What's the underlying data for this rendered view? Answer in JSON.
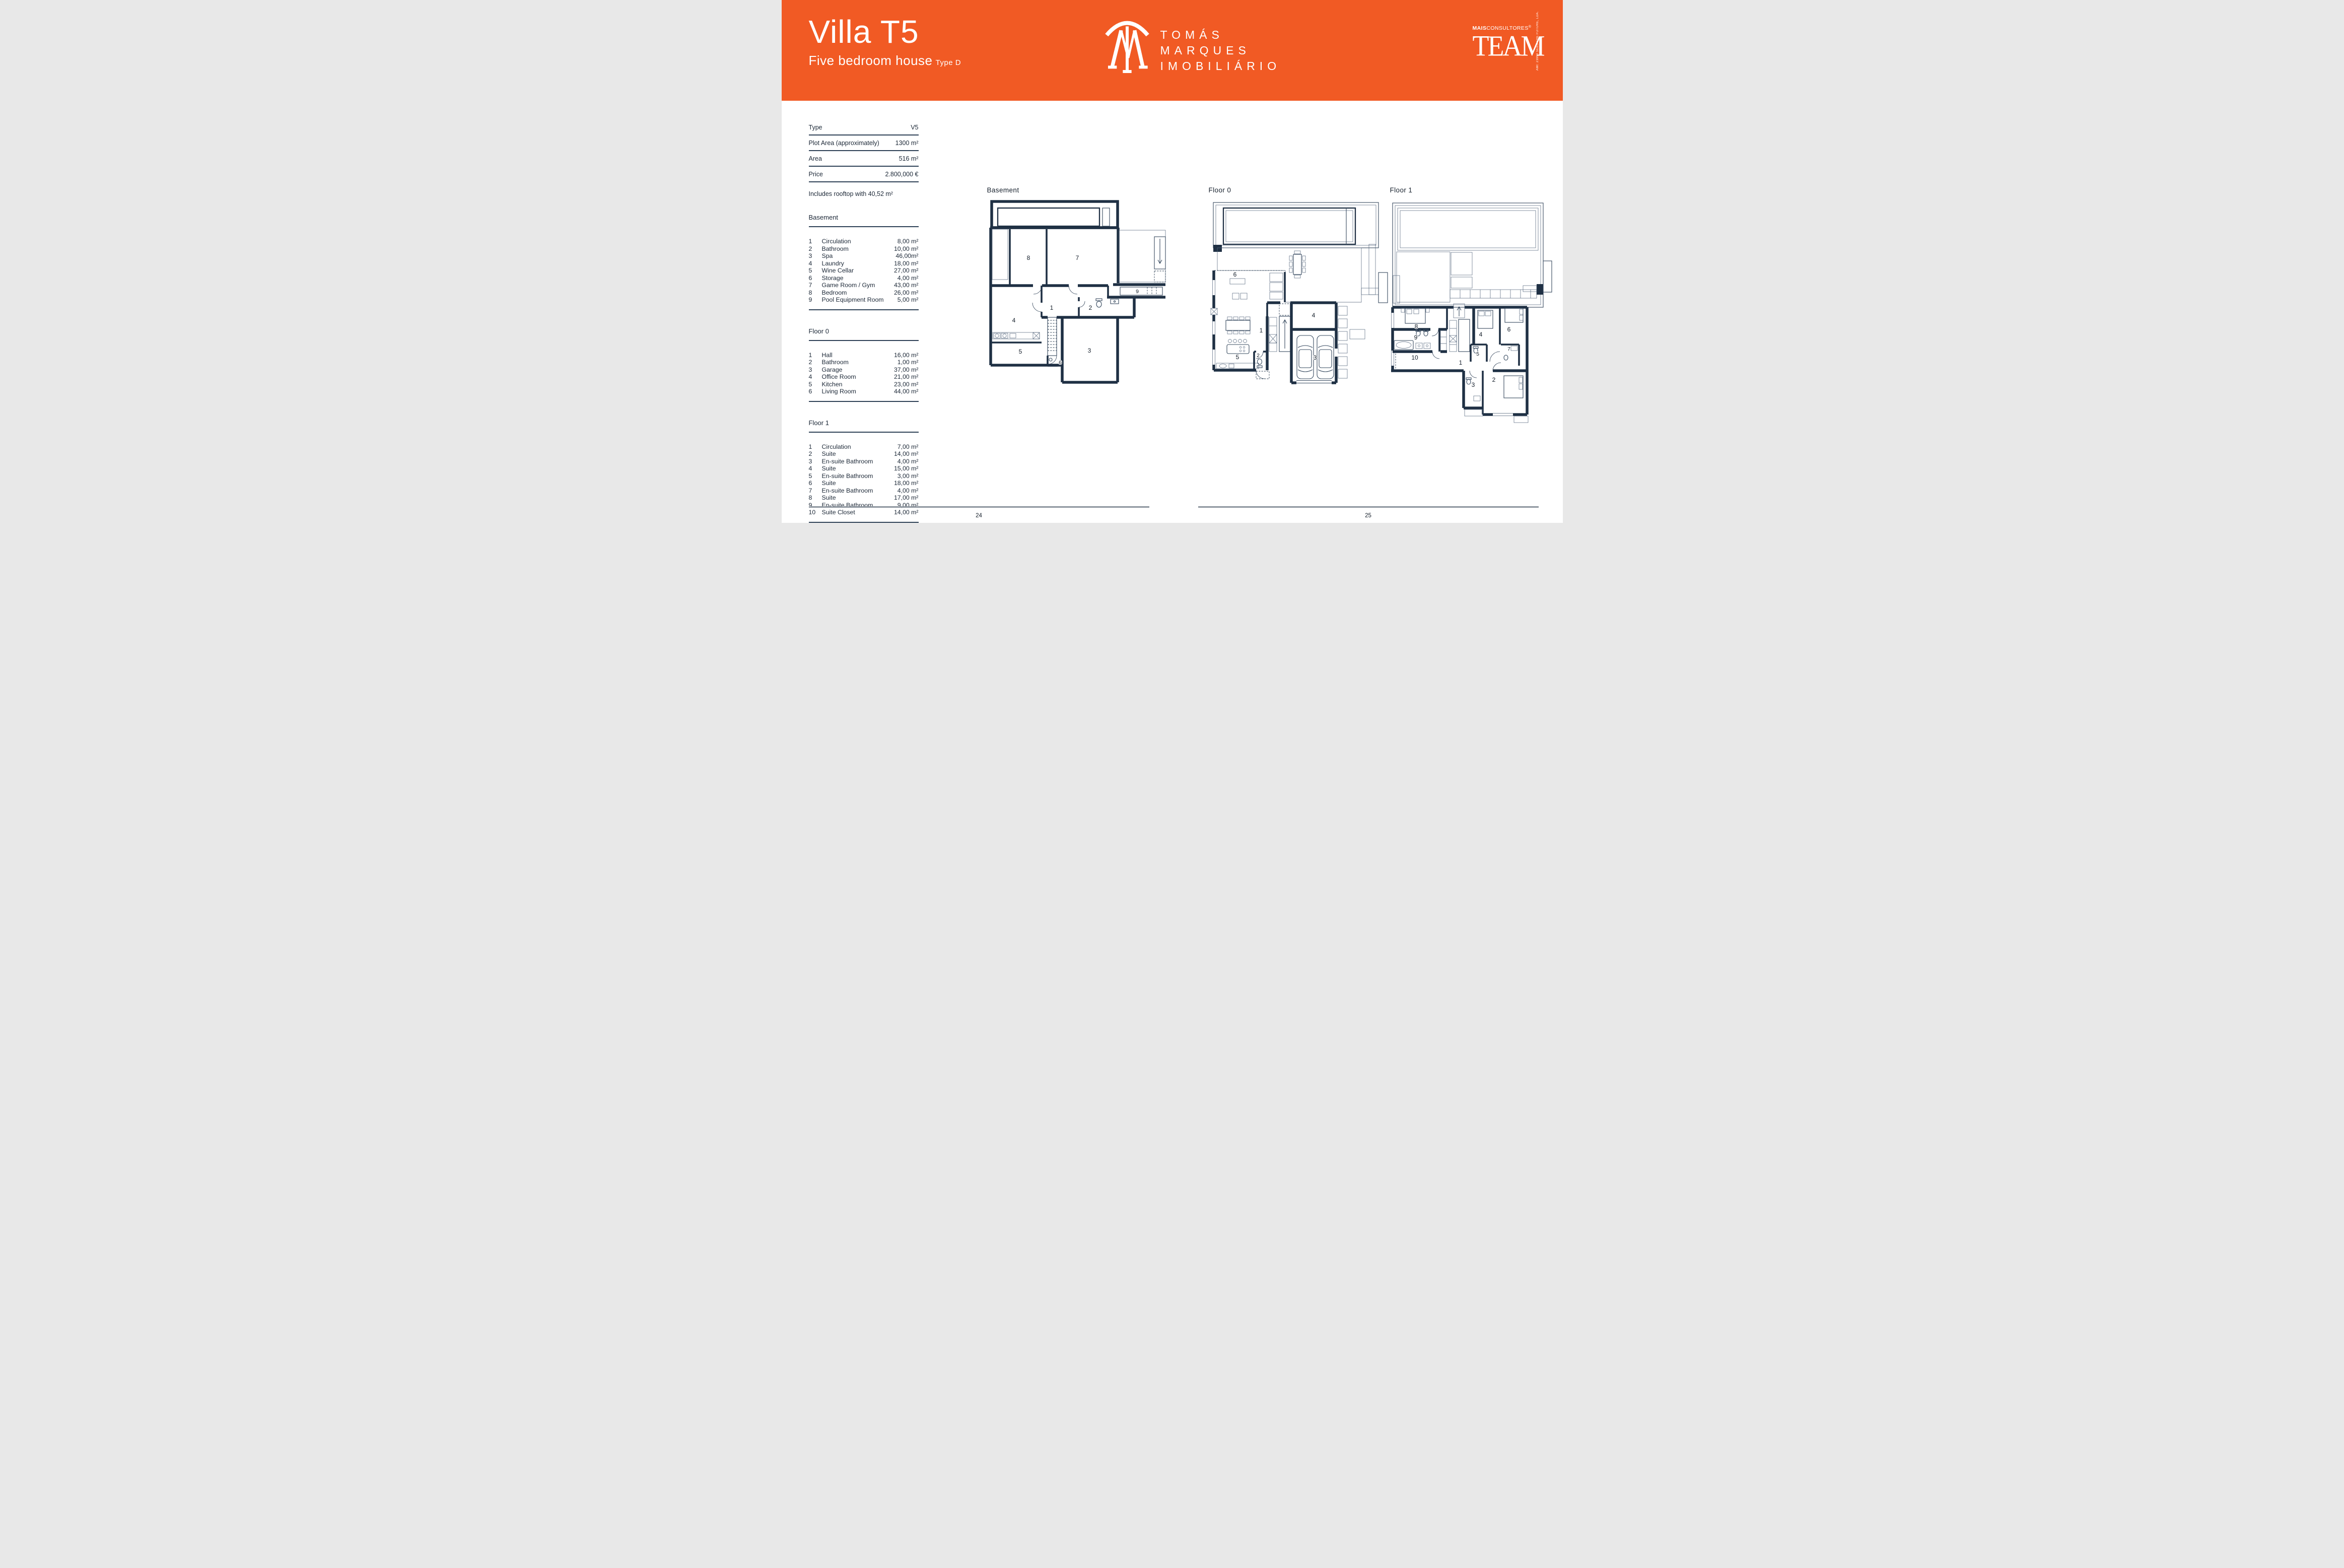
{
  "header": {
    "title": "Villa T5",
    "subtitle": "Five bedroom house",
    "type_tag": "Type D",
    "brand_lines": [
      "TOMÁS",
      "MARQUES",
      "IMOBILIÁRIO"
    ],
    "partner": {
      "bold": "MAIS",
      "rest": "CONSULTORES",
      "reg": "®",
      "word": "TEAM",
      "vertical": "AMI: 23990  SEED THE FUTURE, LDA."
    },
    "accent_color": "#F15A24"
  },
  "specs": {
    "rows": [
      {
        "label": "Type",
        "value": "V5"
      },
      {
        "label": "Plot Area (approximately)",
        "value": "1300 m²"
      },
      {
        "label": "Area",
        "value": "516 m²"
      },
      {
        "label": "Price",
        "value": "2.800,000 €"
      }
    ],
    "note": "Includes rooftop with 40,52 m²"
  },
  "room_sections": [
    {
      "title": "Basement",
      "rows": [
        [
          "1",
          "Circulation",
          "8,00 m²"
        ],
        [
          "2",
          "Bathroom",
          "10,00 m²"
        ],
        [
          "3",
          "Spa",
          "46,00m²"
        ],
        [
          "4",
          "Laundry",
          "18,00 m²"
        ],
        [
          "5",
          "Wine Cellar",
          "27,00 m²"
        ],
        [
          "6",
          "Storage",
          "4,00 m²"
        ],
        [
          "7",
          "Game Room / Gym",
          "43,00 m²"
        ],
        [
          "8",
          "Bedroom",
          "26,00 m²"
        ],
        [
          "9",
          "Pool Equipment Room",
          "5,00 m²"
        ]
      ]
    },
    {
      "title": "Floor 0",
      "rows": [
        [
          "1",
          "Hall",
          "16,00 m²"
        ],
        [
          "2",
          "Bathroom",
          "1,00 m²"
        ],
        [
          "3",
          "Garage",
          "37,00 m²"
        ],
        [
          "4",
          "Office Room",
          "21,00 m²"
        ],
        [
          "5",
          "Kitchen",
          "23,00 m²"
        ],
        [
          "6",
          "Living Room",
          "44,00 m²"
        ]
      ]
    },
    {
      "title": "Floor 1",
      "rows": [
        [
          "1",
          "Circulation",
          "7,00 m²"
        ],
        [
          "2",
          "Suite",
          "14,00 m²"
        ],
        [
          "3",
          "En-suite Bathroom",
          "4,00 m²"
        ],
        [
          "4",
          "Suite",
          "15,00 m²"
        ],
        [
          "5",
          "En-suite Bathroom",
          "3,00 m²"
        ],
        [
          "6",
          "Suite",
          "18,00 m²"
        ],
        [
          "7",
          "En-suite Bathroom",
          "4,00 m²"
        ],
        [
          "8",
          "Suite",
          "17,00 m²"
        ],
        [
          "9",
          "En-suite Bathroom",
          "9,00 m²"
        ],
        [
          "10",
          "Suite Closet",
          "14,00 m²"
        ]
      ]
    }
  ],
  "plans": [
    {
      "title": "Basement",
      "room_labels": [
        "8",
        "7",
        "9",
        "1",
        "2",
        "4",
        "5",
        "6",
        "3"
      ]
    },
    {
      "title": "Floor 0",
      "room_labels": [
        "6",
        "4",
        "1",
        "2",
        "5",
        "3"
      ]
    },
    {
      "title": "Floor 1",
      "room_labels": [
        "8",
        "4",
        "6",
        "9",
        "5",
        "7",
        "10",
        "1",
        "2",
        "3"
      ]
    }
  ],
  "footer": {
    "left_page": "24",
    "right_page": "25"
  }
}
